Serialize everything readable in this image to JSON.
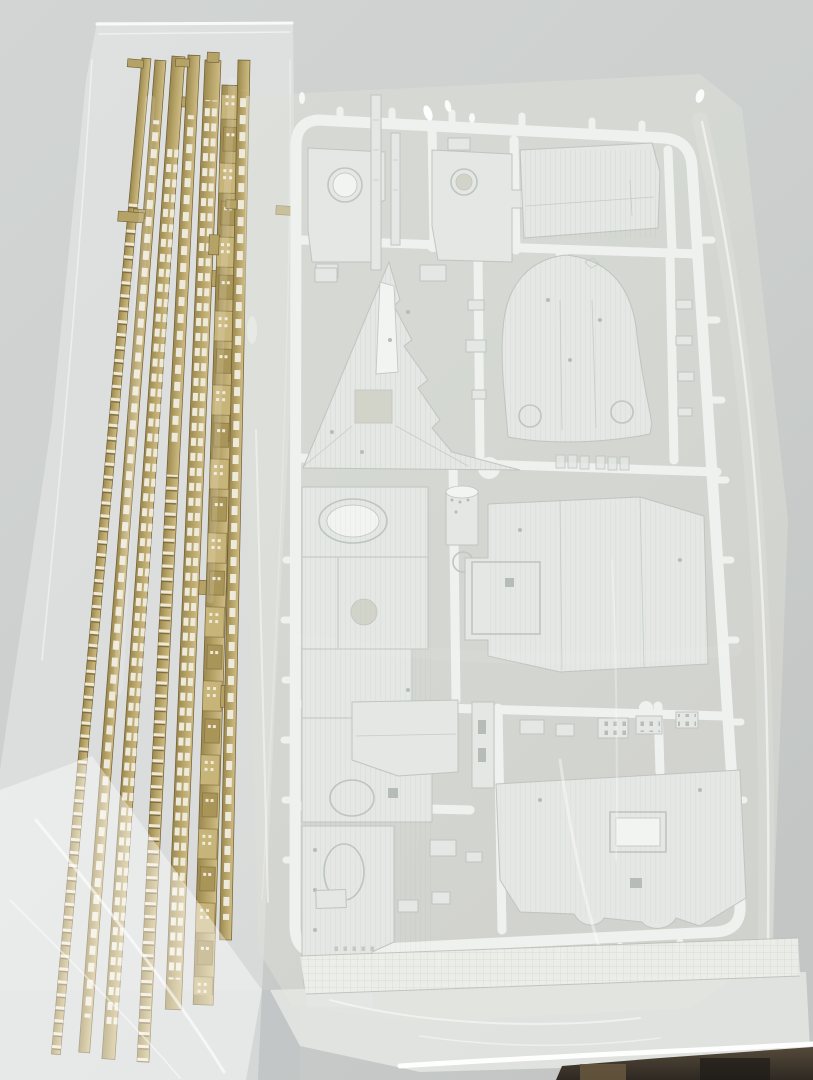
{
  "meta": {
    "type": "photograph",
    "subject": "Plastic scale-model kit sprues sealed in clear plastic bags on a light gray surface",
    "text_visible": "none (only an illegible molded part code on the sprue runner)"
  },
  "objects": {
    "surface": {
      "label": "light-gray-tabletop"
    },
    "tan_bag": {
      "label": "clear-bag-with-tan-strips",
      "strip_count": 7,
      "strip_kinds": [
        "ladder-rail",
        "window-wall",
        "window-wall",
        "ladder-rail",
        "window-wall",
        "stepped-superstructure-wall",
        "window-wall"
      ]
    },
    "white_bag": {
      "label": "clear-bag-with-white-sprue",
      "features": [
        "heat-sealed-textured-seam",
        "bottom-fold",
        "crinkle-highlights"
      ]
    },
    "white_sprue": {
      "label": "white-ship-model-sprue",
      "parts": [
        "plate-with-round-recess",
        "mast-pieces",
        "plate-with-circular-opening",
        "large-flat-panel",
        "bow-deck-triangle",
        "stern-deck-rounded",
        "long-main-deck-strip",
        "funnel-cylinder",
        "large-notched-panel",
        "small-window-grid-parts",
        "lower-hatch-panel",
        "small-lower-parts",
        "molded-part-code (illegible)"
      ]
    },
    "dark_table_edge": {
      "label": "dark-edge-below-bag-bottom-right"
    }
  },
  "colors": {
    "background-top": "#d2d5d4",
    "background-mid": "#cccfce",
    "background-low": "#c3c6c5",
    "sprue-white": "#eef0ed",
    "part-fill": "#e1e5e1",
    "part-light": "#f0f3f0",
    "part-edge": "#b8bfb9",
    "hole-fill": "#cdd0c4",
    "bag-tint": "#d6d8cc",
    "tan-light": "#cfbc85",
    "tan-mid": "#b5a266",
    "tan-dark": "#9b8850",
    "tan-edge": "#6e5d33",
    "window-fill": "#eeeadb",
    "seam-fill": "#eceee9",
    "dark-strip": "#2e2922",
    "dark-strip-brown": "#6b5a41"
  }
}
